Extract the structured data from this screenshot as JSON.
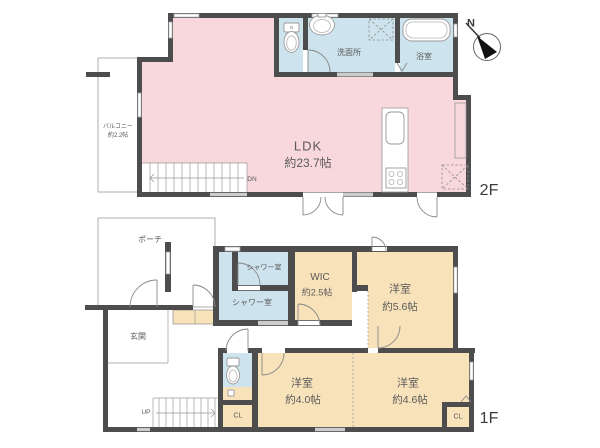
{
  "f2": {
    "floor_label": "2F",
    "ldk": {
      "name": "LDK",
      "size": "約23.7帖"
    },
    "washroom": "洗面所",
    "bathroom": "浴室",
    "balcony": {
      "name": "バルコニー",
      "size": "約2.2帖"
    },
    "stairs_dir": "DN"
  },
  "f1": {
    "floor_label": "1F",
    "porch": "ポーチ",
    "entrance": "玄関",
    "shower_room_small": "シャワー室",
    "shower_room_large": "シャワー室",
    "wic": {
      "name": "WIC",
      "size": "約2.5帖"
    },
    "bedroom_a": {
      "name": "洋室",
      "size": "約5.6帖"
    },
    "bedroom_b": {
      "name": "洋室",
      "size": "約4.0帖"
    },
    "bedroom_c": {
      "name": "洋室",
      "size": "約4.6帖"
    },
    "closet_a": "CL",
    "closet_b": "CL",
    "stairs_dir": "UP"
  },
  "compass": {
    "north": "N"
  },
  "colors": {
    "wall": "#4d4d4d",
    "ldk_pink": "#f8d8dd",
    "wet_blue": "#cde4ee",
    "room_tan": "#f8e2ba",
    "outline": "#9a9a9a",
    "door": "#8a8a8a"
  }
}
